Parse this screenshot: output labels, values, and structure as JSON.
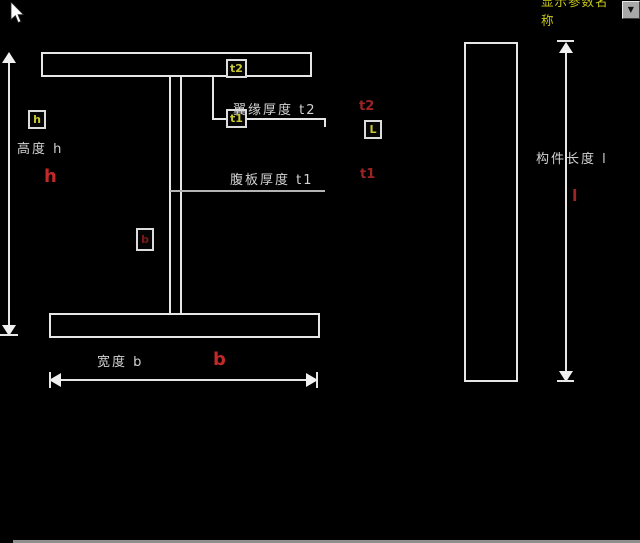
{
  "header": {
    "param_selector": {
      "value": "显示参数名称",
      "dropdown_glyph": "▼"
    },
    "cursor_icon": "arrow-pointer"
  },
  "colors": {
    "background": "#000000",
    "line": "#e6e6e6",
    "box_label_yellow": "#c8c832",
    "param_red_bright": "#c42929",
    "param_red_dark": "#9d2424",
    "dropdown_yellow": "#c9c916"
  },
  "labels": {
    "height": "高度 h",
    "flange_thickness": "翼缘厚度 t2",
    "web_thickness": "腹板厚度 t1",
    "width": "宽度 b",
    "member_length": "构件长度 l"
  },
  "params": {
    "h": "h",
    "t2": "t2",
    "t1": "t1",
    "b": "b",
    "l": "l"
  },
  "boxes": {
    "h": "h",
    "t2": "t2",
    "t1": "t1",
    "b": "b",
    "L": "L"
  }
}
